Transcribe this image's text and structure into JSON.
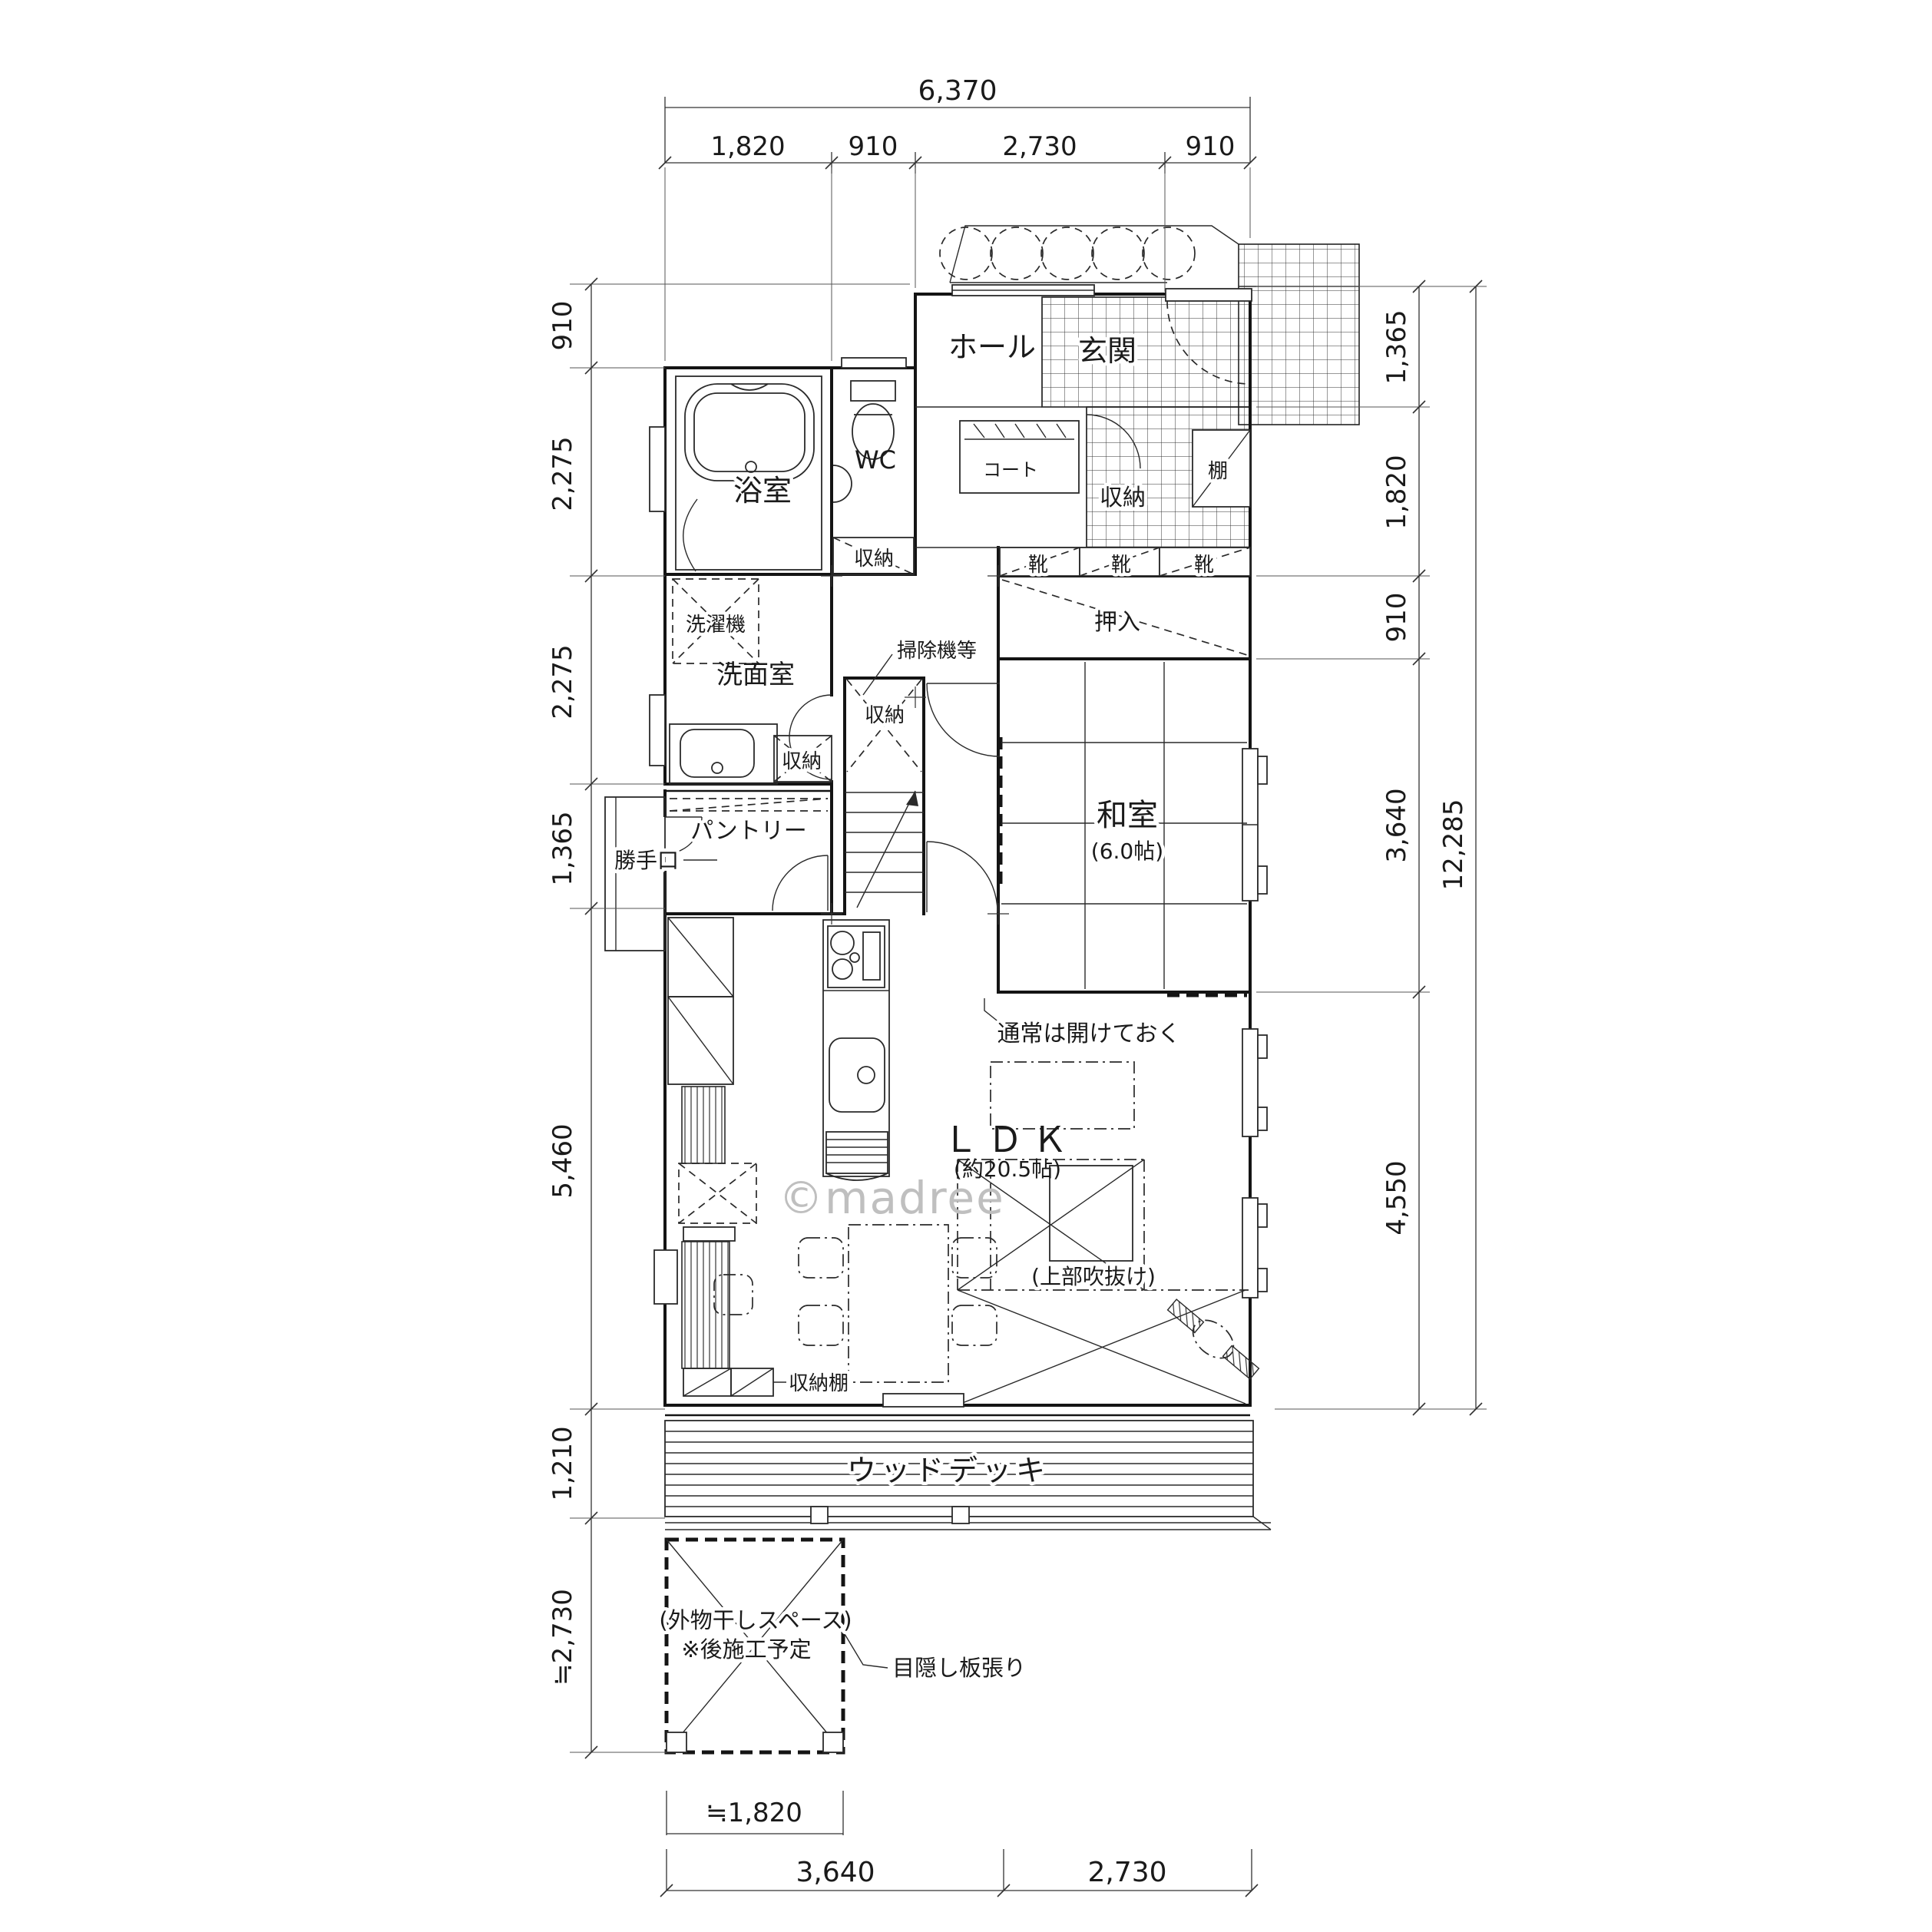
{
  "watermark": "©madree",
  "dimensions": {
    "top": {
      "total": "6,370",
      "segments": [
        "1,820",
        "910",
        "2,730",
        "910"
      ]
    },
    "left": {
      "segments": [
        "910",
        "2,275",
        "2,275",
        "1,365",
        "5,460",
        "1,210",
        "≒2,730"
      ]
    },
    "right": {
      "segments": [
        "1,365",
        "1,820",
        "910",
        "3,640",
        "4,550"
      ],
      "total": "12,285"
    },
    "bottom": {
      "segments": [
        "3,640",
        "2,730"
      ],
      "approx": "≒1,820"
    }
  },
  "rooms": {
    "hall": "ホール",
    "genkan": "玄関",
    "bath": "浴室",
    "wc": "WC",
    "washroom": "洗面室",
    "washitsu": "和室",
    "washitsu_size": "(6.0帖)",
    "ldk": "ＬＤＫ",
    "ldk_size": "(約20.5帖)",
    "pantry": "パントリー",
    "wood_deck": "ウッドデッキ"
  },
  "fixtures": {
    "storage": "収納",
    "washer": "洗濯機",
    "vacuum": "掃除機等",
    "coat": "コート",
    "shelf": "棚",
    "shoes": "靴",
    "oshiire": "押入",
    "backdoor": "勝手口",
    "storage_shelf": "収納棚",
    "keep_open": "通常は開けておく",
    "void_above": "(上部吹抜け)",
    "drying_space": "(外物干しスペース)",
    "drying_note": "※後施工予定",
    "blind": "目隠し板張り"
  }
}
